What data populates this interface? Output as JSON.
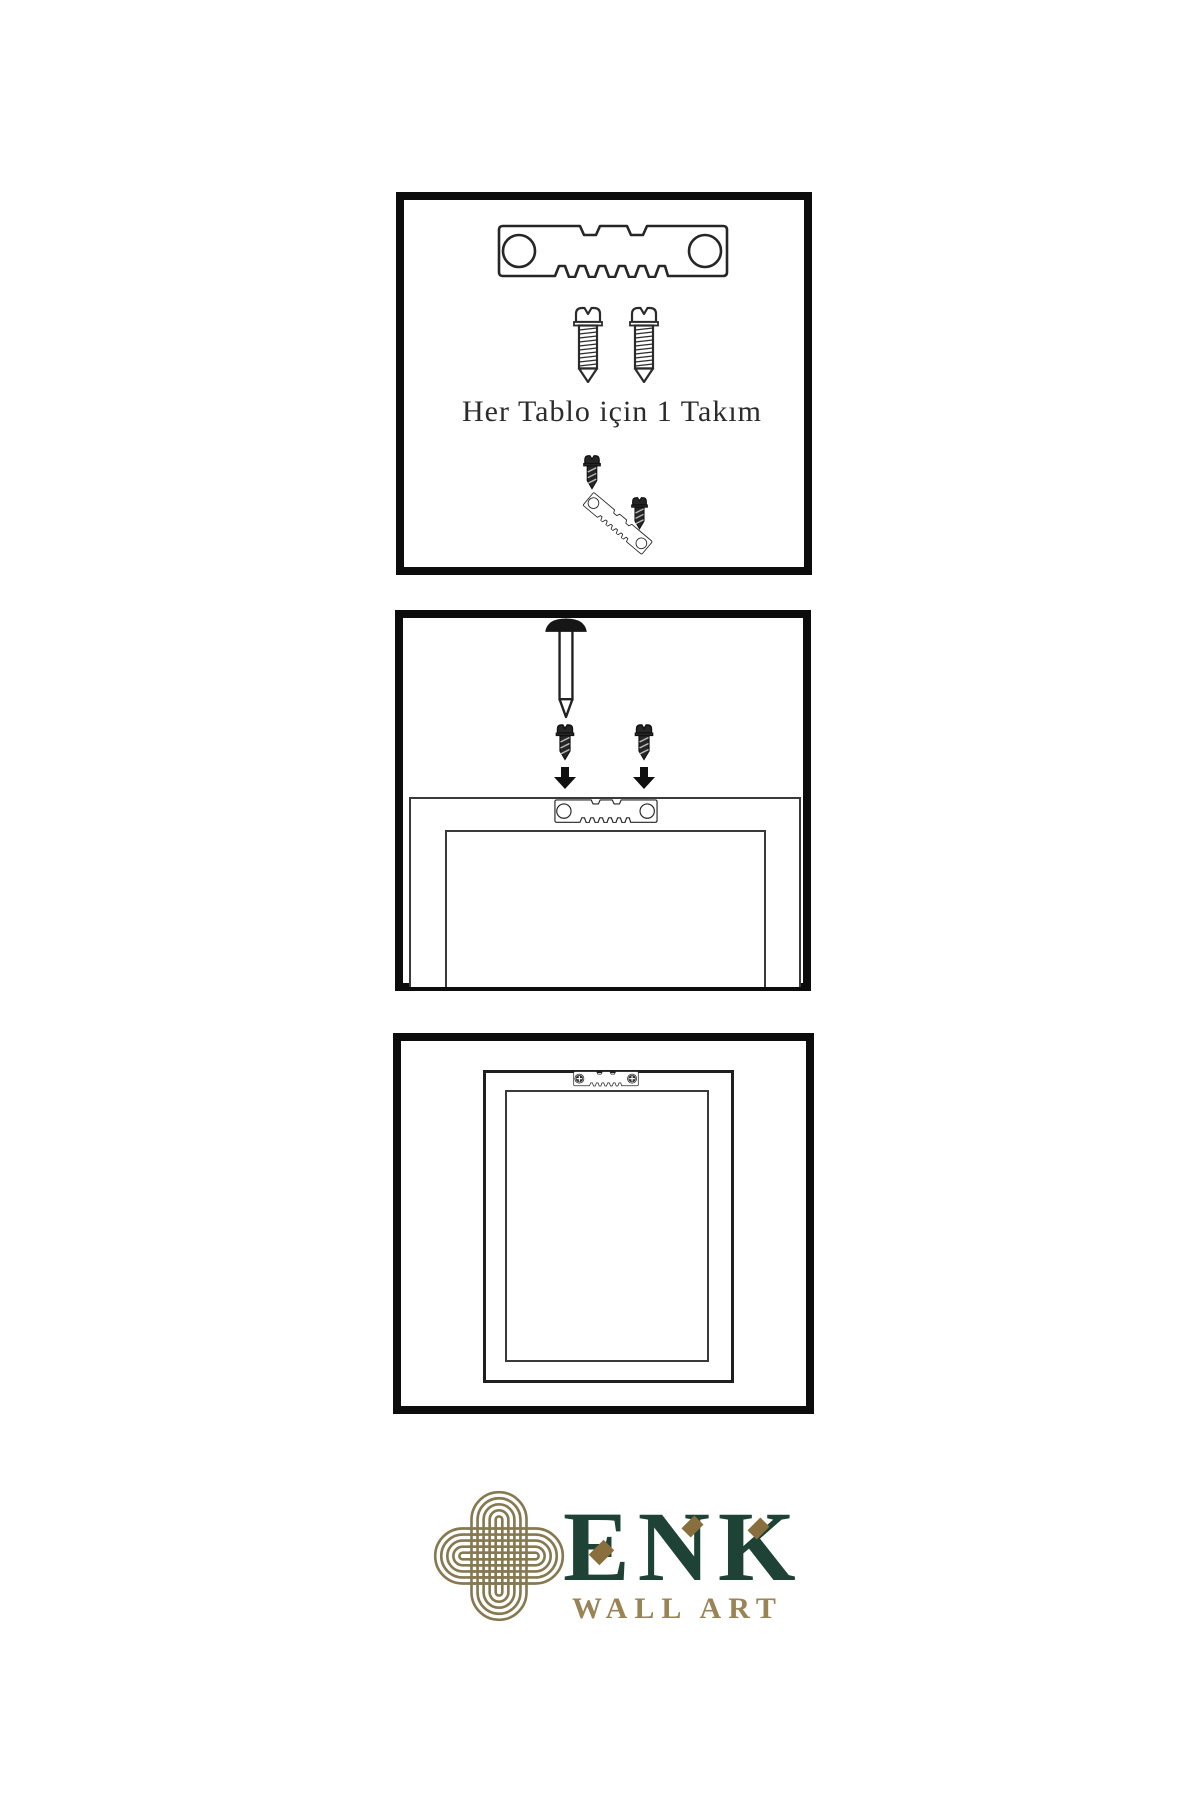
{
  "meta": {
    "kind": "wall-art hanging instructions sheet"
  },
  "colors": {
    "background": "#ffffff",
    "line_art": "#262626",
    "panel_border": "#0c0c0c",
    "logo_green": "#1e4236",
    "logo_gold": "#867950",
    "logo_gold_text": "#9a8355",
    "logo_diamond": "#8a6f3e"
  },
  "step1": {
    "caption": "Her Tablo için 1 Takım",
    "icons": [
      "sawtooth-hanger-icon",
      "screw-icon",
      "screw-icon",
      "screw-dark-icon",
      "tilted-hanger-with-screw-icon"
    ]
  },
  "step2": {
    "icons": [
      "wall-nail-icon",
      "screw-dark-icon",
      "screw-dark-icon",
      "arrow-down-icon",
      "arrow-down-icon",
      "sawtooth-hanger-icon",
      "frame-back-outline"
    ]
  },
  "step3": {
    "icons": [
      "installed-hanger-icon",
      "frame-back-outline"
    ]
  },
  "brand": {
    "name": "ENK",
    "tagline": "WALL ART",
    "logo": "knot-icon"
  }
}
